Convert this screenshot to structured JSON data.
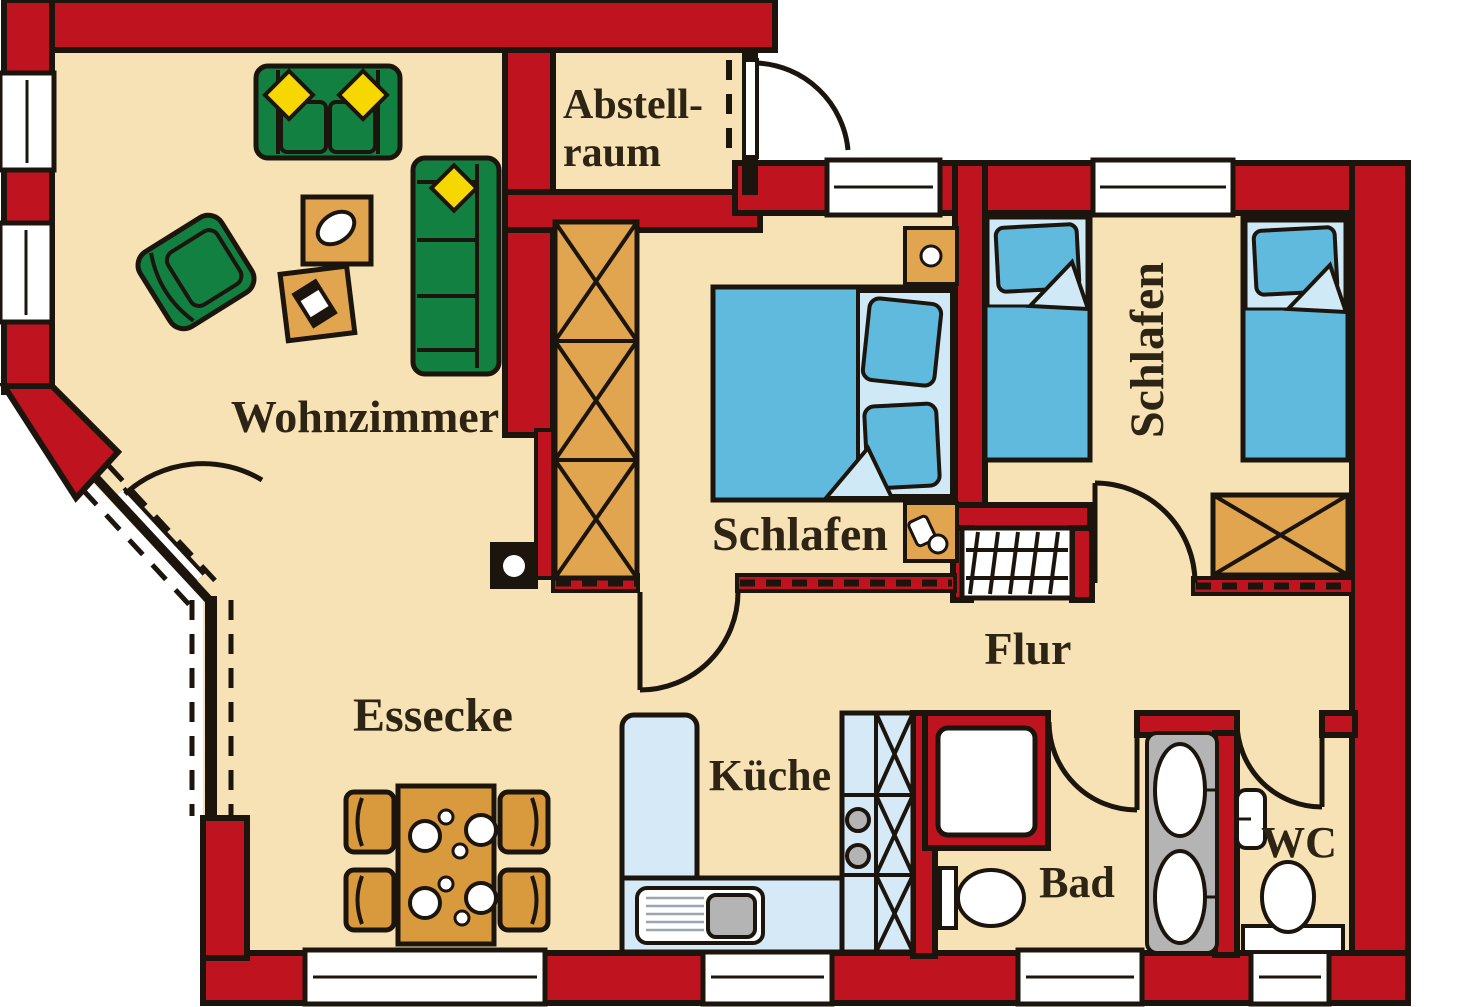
{
  "title": "Wohnungsgrundriss",
  "colors": {
    "wall": "#bf141f",
    "wallDark": "#8f1018",
    "floor": "#f6e2b5",
    "outline": "#1c150d",
    "sofa": "#128040",
    "cushion": "#f6d700",
    "wood": "#e2a54f",
    "woodDark": "#d9993d",
    "bed": "#5fbade",
    "bedLight": "#cfe9f7",
    "counter": "#d6e9f6",
    "fixtureGray": "#b4b4b4",
    "text": "#2e2414"
  },
  "rooms": {
    "wohnzimmer": {
      "label": "Wohnzimmer"
    },
    "abstellraum": {
      "line1": "Abstell-",
      "line2": "raum"
    },
    "schlafen_mitte": {
      "label": "Schlafen"
    },
    "schlafen_rechts": {
      "label": "Schlafen"
    },
    "flur": {
      "label": "Flur"
    },
    "essecke": {
      "label": "Essecke"
    },
    "kueche": {
      "label": "Küche"
    },
    "bad": {
      "label": "Bad"
    },
    "wc": {
      "label": "WC"
    }
  }
}
